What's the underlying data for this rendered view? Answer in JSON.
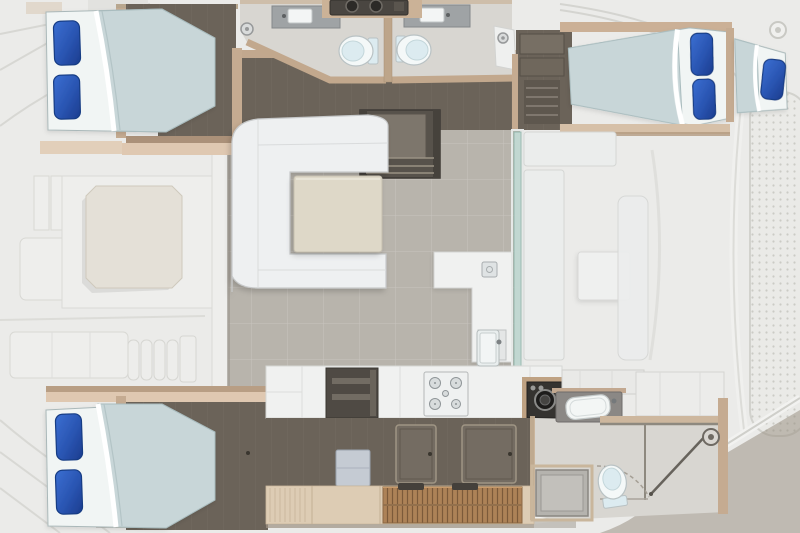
{
  "scene": {
    "kind": "yacht-floorplan-top-view",
    "canvas": {
      "width": 800,
      "height": 533
    }
  },
  "palette": {
    "deck": "#ebebe9",
    "deck_line": "#d7d7d3",
    "deck_panel": "#eeeeec",
    "floor_dark": "#6b6359",
    "wall_tan": "#c5ab91",
    "wall_tan_dark": "#ab9179",
    "walkway_beige": "#dfc8b1",
    "duvet": "#c8d6d8",
    "sheet": "#f1f5f4",
    "pillow": "#2a55b2",
    "pillow_deep": "#1b3c8e",
    "head_floor": "#d8d6d1",
    "counter_grey": "#9fa3a5",
    "porcelain": "#f4f8f8",
    "porcelain_shadow": "#dcebf0",
    "salon_tile": "#b8b4ac",
    "sofa": "#eef0f1",
    "table": "#ded8c8",
    "counter_white": "#f0f1f0",
    "shelf_dark": "#4f4a44",
    "appliance_dark": "#353330",
    "wood_walkway": "#ddccb4",
    "teak": "#ad8257",
    "teak_line": "#7c5a3a",
    "hatch": "#746c62",
    "glass": "#c2d9d3",
    "shower_pan": "#b5b3ae",
    "transom": "#93897c",
    "pad": "#e4e0d7"
  },
  "regions": {
    "deck": {
      "features": [
        "sunpad",
        "deck-lockers",
        "side-steps",
        "trampoline-mesh",
        "aft-platform",
        "deck-fitting-ring"
      ]
    },
    "upper_hull": {
      "cabin_left": {
        "beds": 1,
        "pillows": 2
      },
      "head_left": {
        "toilets": 1,
        "sinks": 1,
        "drain_fittings": 1
      },
      "head_right": {
        "toilets": 1,
        "sinks": 1,
        "drain_fittings": 1
      },
      "cabin_right": {
        "beds": 2,
        "pillows": 3
      }
    },
    "salon": {
      "sofa": "C-shaped",
      "tables": 1,
      "step_wells": 1,
      "l_counter": 1,
      "counter_sink": 1,
      "sliding_doors": 1
    },
    "cockpit": {
      "benches": 3,
      "tables": 1
    },
    "lower_hull": {
      "cabin_left": {
        "beds": 1,
        "pillows": 2
      },
      "galley": {
        "stove_burners": 5,
        "sinks": 1,
        "open_shelves": 1,
        "floor_hatches": 2,
        "round_door_appliance": 1,
        "teak_steps": 1
      },
      "head_right": {
        "toilets": 1,
        "basins": 1,
        "shower_pans": 1,
        "shower_heads": 1,
        "glass_doors": 1
      }
    },
    "bow_equipment": {
      "windlass_drums": 2
    }
  }
}
